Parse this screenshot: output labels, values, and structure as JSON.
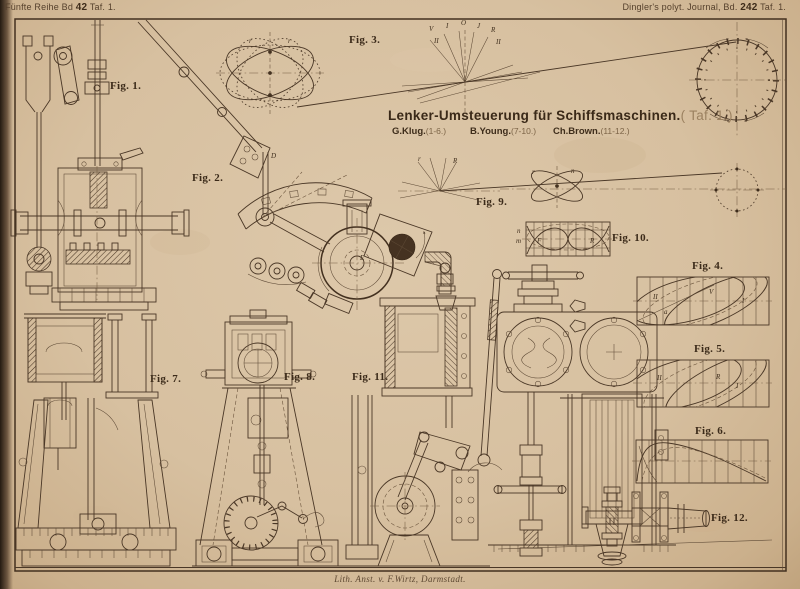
{
  "plate": {
    "header_left": {
      "prefix": "Fünfte Reihe Bd",
      "number": "42",
      "suffix": "Taf. 1."
    },
    "header_right": {
      "prefix": "Dingler's polyt. Journal, Bd.",
      "number": "242",
      "suffix": "Taf. 1."
    },
    "caption": "Lith. Anst. v. F.Wirtz, Darmstadt."
  },
  "title": {
    "main": "Lenker-Umsteuerung für Schiffsmaschinen.",
    "plate_ref": "( Taf. 1.)",
    "authors": [
      {
        "name": "G.Klug.",
        "figs": "(1-6.)"
      },
      {
        "name": "B.Young.",
        "figs": "(7-10.)"
      },
      {
        "name": "Ch.Brown.",
        "figs": "(11-12.)"
      }
    ]
  },
  "figures": [
    {
      "label": "Fig. 1."
    },
    {
      "label": "Fig. 2."
    },
    {
      "label": "Fig. 3."
    },
    {
      "label": "Fig. 4."
    },
    {
      "label": "Fig. 5."
    },
    {
      "label": "Fig. 6."
    },
    {
      "label": "Fig. 7."
    },
    {
      "label": "Fig. 8."
    },
    {
      "label": "Fig. 9."
    },
    {
      "label": "Fig. 10."
    },
    {
      "label": "Fig. 11."
    },
    {
      "label": "Fig. 12."
    }
  ],
  "letters": {
    "fan": [
      "V",
      "I",
      "O",
      "J",
      "R",
      "II",
      "II"
    ],
    "fig2": [
      "D",
      "E"
    ],
    "fig9": [
      "r",
      "R",
      "r",
      "n"
    ],
    "fig10": [
      "F",
      "R",
      "n",
      "m"
    ],
    "fig4": [
      "II",
      "V",
      "I",
      "a"
    ],
    "fig5": [
      "II",
      "R",
      "I"
    ]
  },
  "colors": {
    "paper": "#d9c3a4",
    "ink": "#4a3726"
  }
}
